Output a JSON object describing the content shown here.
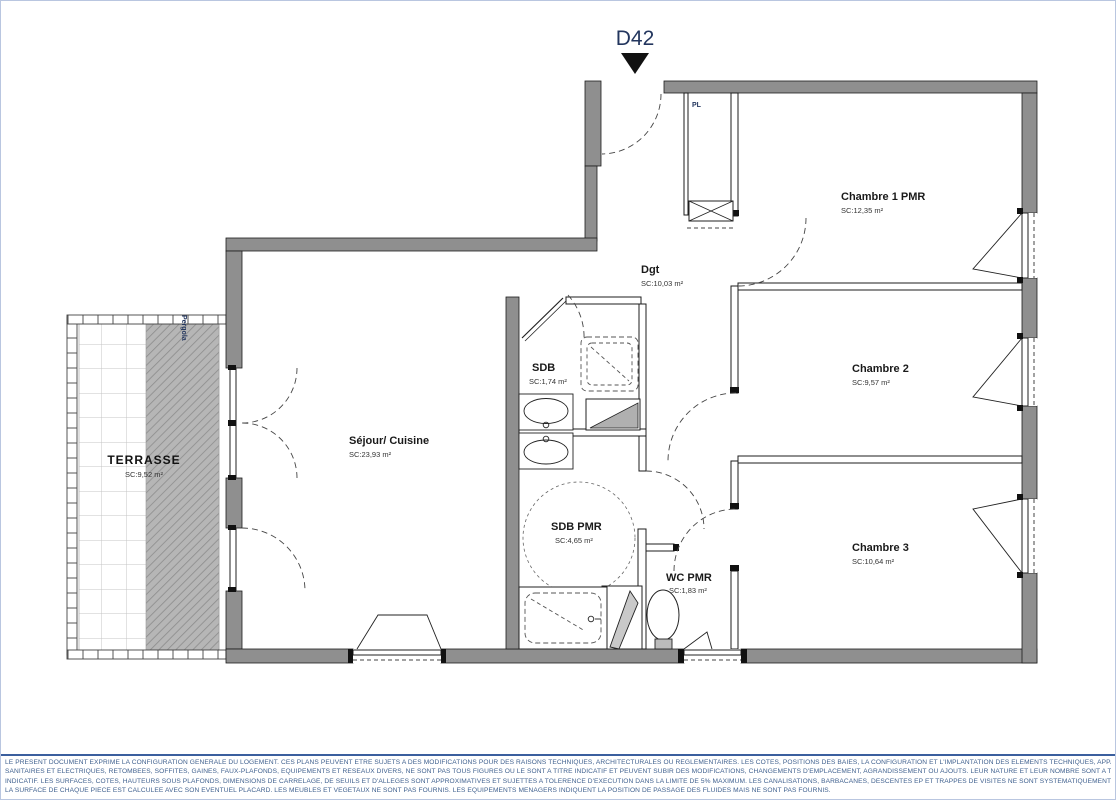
{
  "header": {
    "unit": "D42"
  },
  "plan": {
    "rooms": [
      {
        "id": "sejour",
        "name": "Séjour/ Cuisine",
        "area": "SC:23,93 m²"
      },
      {
        "id": "terrasse",
        "name": "TERRASSE",
        "area": "SC:9,52 m²"
      },
      {
        "id": "dgt",
        "name": "Dgt",
        "area": "SC:10,03 m²"
      },
      {
        "id": "sdb",
        "name": "SDB",
        "area": "SC:1,74 m²"
      },
      {
        "id": "sdb-pmr",
        "name": "SDB PMR",
        "area": "SC:4,65 m²"
      },
      {
        "id": "wc-pmr",
        "name": "WC PMR",
        "area": "SC:1,83 m²"
      },
      {
        "id": "chambre1",
        "name": "Chambre 1 PMR",
        "area": "SC:12,35 m²"
      },
      {
        "id": "chambre2",
        "name": "Chambre 2",
        "area": "SC:9,57 m²"
      },
      {
        "id": "chambre3",
        "name": "Chambre 3",
        "area": "SC:10,64 m²"
      }
    ],
    "annotations": {
      "closet": "PL",
      "pergola": "Pergola"
    }
  },
  "footer": {
    "lines": [
      "LE PRESENT DOCUMENT EXPRIME LA CONFIGURATION GENERALE DU LOGEMENT. CES PLANS PEUVENT ETRE SUJETS A DES MODIFICATIONS POUR DES RAISONS TECHNIQUES, ARCHITECTURALES OU REGLEMENTAIRES. LES COTES, POSITIONS DES BAIES, LA CONFIGURATION ET L'IMPLANTATION DES ELEMENTS TECHNIQUES, APPAREILS",
      "SANITAIRES ET ELECTRIQUES, RETOMBEES, SOFFITES, GAINES, FAUX-PLAFONDS, EQUIPEMENTS ET RESEAUX DIVERS, NE SONT PAS TOUS FIGURES OU LE SONT A TITRE INDICATIF ET PEUVENT SUBIR DES MODIFICATIONS, CHANGEMENTS D'EMPLACEMENT, AGRANDISSEMENT OU AJOUTS. LEUR NATURE ET LEUR NOMBRE SONT A TITRE",
      "INDICATIF. LES SURFACES, COTES, HAUTEURS SOUS PLAFONDS, DIMENSIONS DE CARRELAGE, DE SEUILS ET D'ALLEGES SONT APPROXIMATIVES ET SUJETTES A TOLERENCE D'EXECUTION DANS LA LIMITE DE 5% MAXIMUM. LES CANALISATIONS, BARBACANES, DESCENTES EP ET TRAPPES DE VISITES NE SONT SYSTEMATIQUEMENT FIGURES.",
      "LA SURFACE DE CHAQUE PIECE EST CALCULEE AVEC SON EVENTUEL PLACARD. LES MEUBLES ET VEGETAUX NE SONT PAS FOURNIS. LES EQUIPEMENTS MENAGERS INDIQUENT LA POSITION DE PASSAGE DES FLUIDES MAIS NE SONT PAS FOURNIS."
    ]
  },
  "colors": {
    "wall": "#8f8f8f",
    "accent": "#23365e",
    "footer_text": "#40618f"
  }
}
